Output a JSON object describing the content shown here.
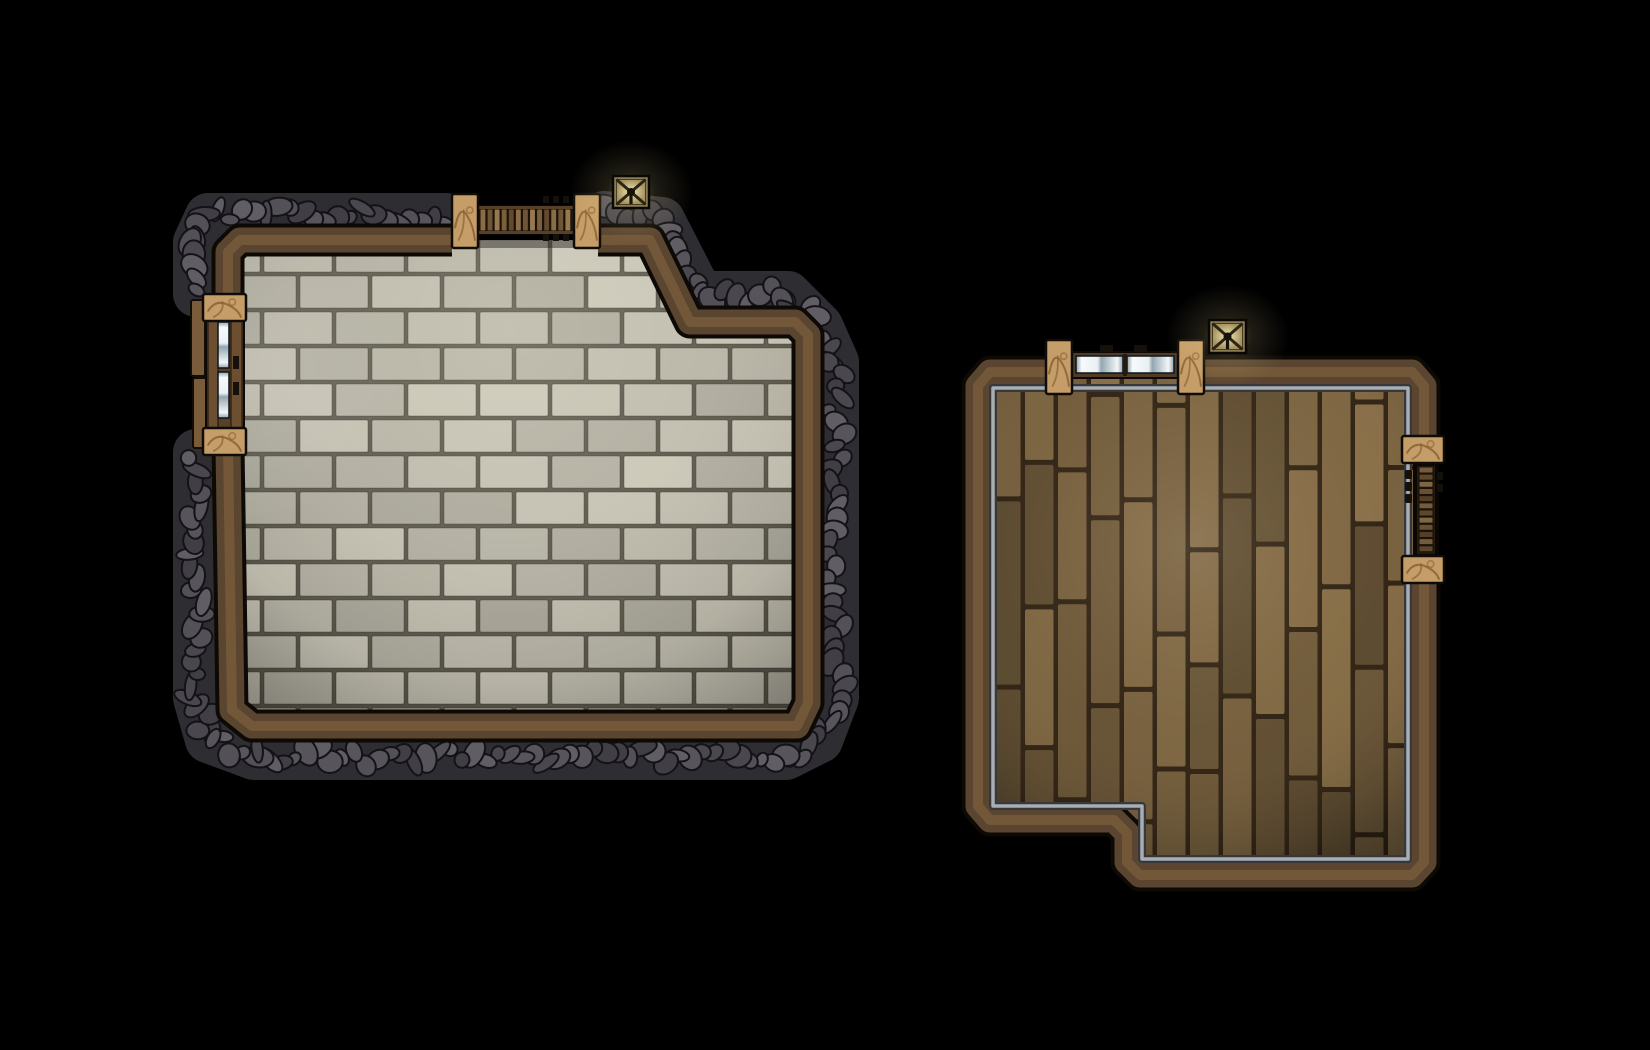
{
  "scene": {
    "description": "Top-down fantasy RPG battle map with two separate rooms on a black background",
    "canvas": {
      "width": 1650,
      "height": 1050
    },
    "background_color": "#000000"
  },
  "palette": {
    "background": "#000000",
    "wall_outline": "#0d0905",
    "wall_wood": "#5a4530",
    "wall_wood_ridge": "#74593a",
    "rock_base": "#2e2d31",
    "rock_tones": [
      "#57545b",
      "#4a474e",
      "#615d64",
      "#413f45",
      "#535057"
    ],
    "rock_outline": "#131217",
    "stone_floor": "#bdbaac",
    "mortar": "#5f5b4e",
    "plank_base": "#75603f",
    "plank_line": "#2d2113",
    "pillar_stone": "#c59d68",
    "pillar_crack": "#8a6134",
    "pillar_outline": "#100c07",
    "door_frame": "#4f3b26",
    "slat_tones": [
      "#8a6c46",
      "#6f5536",
      "#97794f",
      "#7a5f3c",
      "#63492e"
    ],
    "glass_hi": "#f6fafc",
    "glass_mid": "#8fa2ad",
    "trim_silver": "#aaaeb1",
    "trim_shadow": "#35393e",
    "lamp_body": "#8c7c54",
    "lamp_face_hi": "#f4e8b6",
    "lamp_face_lo": "#a3935f",
    "lamp_cross": "#2c2414",
    "glow": "#ffe9a0",
    "hardware_dark": "#15100a"
  },
  "stone_room": {
    "name": "stone brick room with rock outer wall",
    "floor_path": [
      [
        228,
        254
      ],
      [
        240,
        240
      ],
      [
        650,
        240
      ],
      [
        690,
        322
      ],
      [
        795,
        322
      ],
      [
        808,
        335
      ],
      [
        808,
        703
      ],
      [
        797,
        726
      ],
      [
        252,
        726
      ],
      [
        232,
        710
      ]
    ],
    "wall_segments": [
      [
        [
          228,
          302
        ],
        [
          228,
          252
        ],
        [
          240,
          240
        ],
        [
          452,
          240
        ]
      ],
      [
        [
          598,
          240
        ],
        [
          650,
          240
        ],
        [
          690,
          322
        ],
        [
          795,
          322
        ],
        [
          808,
          335
        ],
        [
          808,
          703
        ],
        [
          797,
          726
        ],
        [
          252,
          726
        ],
        [
          232,
          710
        ],
        [
          228,
          446
        ]
      ]
    ],
    "brick": {
      "x": 190,
      "y": 238,
      "x2": 812,
      "y2": 730,
      "w": 72,
      "h": 36
    },
    "light": {
      "cx": 510,
      "cy": 330,
      "r": 520
    },
    "window_glow": {
      "cx": 258,
      "cy": 372,
      "r": 150
    },
    "rock_segments": [
      [
        [
          446,
          216
        ],
        [
          208,
          216
        ],
        [
          196,
          242
        ],
        [
          196,
          294
        ]
      ],
      [
        [
          604,
          214
        ],
        [
          662,
          220
        ],
        [
          700,
          294
        ],
        [
          788,
          294
        ],
        [
          820,
          326
        ],
        [
          836,
          362
        ],
        [
          836,
          698
        ],
        [
          820,
          740
        ],
        [
          786,
          757
        ],
        [
          254,
          757
        ],
        [
          208,
          740
        ],
        [
          196,
          698
        ],
        [
          196,
          452
        ]
      ]
    ],
    "north_door": {
      "pillars": [
        [
          452,
          194,
          26,
          54
        ],
        [
          574,
          194,
          26,
          54
        ]
      ],
      "slats": [
        478,
        206,
        96,
        28
      ],
      "marks": [
        [
          543,
          196,
          26,
          7
        ],
        [
          543,
          234,
          26,
          7
        ]
      ]
    },
    "west_door": {
      "outer_planks": [
        [
          191,
          300,
          14,
          76
        ],
        [
          193,
          378,
          15,
          70
        ]
      ],
      "blocks": [
        [
          203,
          294,
          43,
          27
        ],
        [
          203,
          428,
          43,
          27
        ]
      ],
      "frame": [
        206,
        316,
        38,
        114
      ],
      "glass": [
        [
          218,
          322,
          11,
          46
        ],
        [
          218,
          372,
          11,
          46
        ]
      ],
      "handles": [
        [
          233,
          356,
          6,
          13
        ],
        [
          233,
          382,
          6,
          13
        ]
      ]
    },
    "lamp": {
      "x": 613,
      "y": 176,
      "w": 36,
      "h": 32
    }
  },
  "wood_room": {
    "name": "wood plank room with silver inner trim",
    "floor_path": [
      [
        978,
        386
      ],
      [
        990,
        372
      ],
      [
        1412,
        372
      ],
      [
        1424,
        386
      ],
      [
        1424,
        862
      ],
      [
        1412,
        875
      ],
      [
        1140,
        875
      ],
      [
        1127,
        862
      ],
      [
        1127,
        833
      ],
      [
        1114,
        820
      ],
      [
        990,
        820
      ],
      [
        978,
        806
      ]
    ],
    "wall_segments": [
      [
        [
          1202,
          372
        ],
        [
          1412,
          372
        ],
        [
          1424,
          386
        ],
        [
          1424,
          442
        ]
      ],
      [
        [
          1424,
          583
        ],
        [
          1424,
          862
        ],
        [
          1412,
          875
        ],
        [
          1140,
          875
        ],
        [
          1127,
          862
        ],
        [
          1127,
          833
        ],
        [
          1114,
          820
        ],
        [
          990,
          820
        ],
        [
          978,
          806
        ],
        [
          978,
          386
        ],
        [
          990,
          372
        ],
        [
          1048,
          372
        ]
      ]
    ],
    "trim_path": [
      [
        993,
        388
      ],
      [
        1408,
        388
      ],
      [
        1408,
        859
      ],
      [
        1142,
        859
      ],
      [
        1142,
        806
      ],
      [
        993,
        806
      ]
    ],
    "planks": {
      "x": 990,
      "y": 368,
      "x2": 1412,
      "y2": 864,
      "w": 33,
      "min": 95,
      "max": 230
    },
    "light": {
      "cx": 1190,
      "cy": 545,
      "r": 450
    },
    "north_door": {
      "pillars": [
        [
          1046,
          340,
          26,
          54
        ],
        [
          1178,
          340,
          26,
          54
        ]
      ],
      "frame": [
        1072,
        352,
        106,
        26
      ],
      "panes": [
        [
          1076,
          356,
          47,
          17
        ],
        [
          1127,
          356,
          47,
          17
        ]
      ],
      "marks": [
        [
          1100,
          345,
          13,
          7
        ],
        [
          1134,
          345,
          13,
          7
        ]
      ]
    },
    "east_door": {
      "pillars": [
        [
          1402,
          436,
          42,
          27
        ],
        [
          1402,
          556,
          42,
          27
        ]
      ],
      "frame": [
        1414,
        462,
        24,
        96
      ],
      "slats": [
        1416,
        465,
        20,
        90
      ],
      "marks": [
        [
          1405,
          470,
          7,
          9
        ],
        [
          1405,
          482,
          7,
          9
        ],
        [
          1405,
          494,
          7,
          9
        ],
        [
          1437,
          472,
          6,
          8
        ],
        [
          1437,
          484,
          6,
          8
        ]
      ]
    },
    "lamp": {
      "x": 1209,
      "y": 320,
      "w": 37,
      "h": 33
    }
  }
}
